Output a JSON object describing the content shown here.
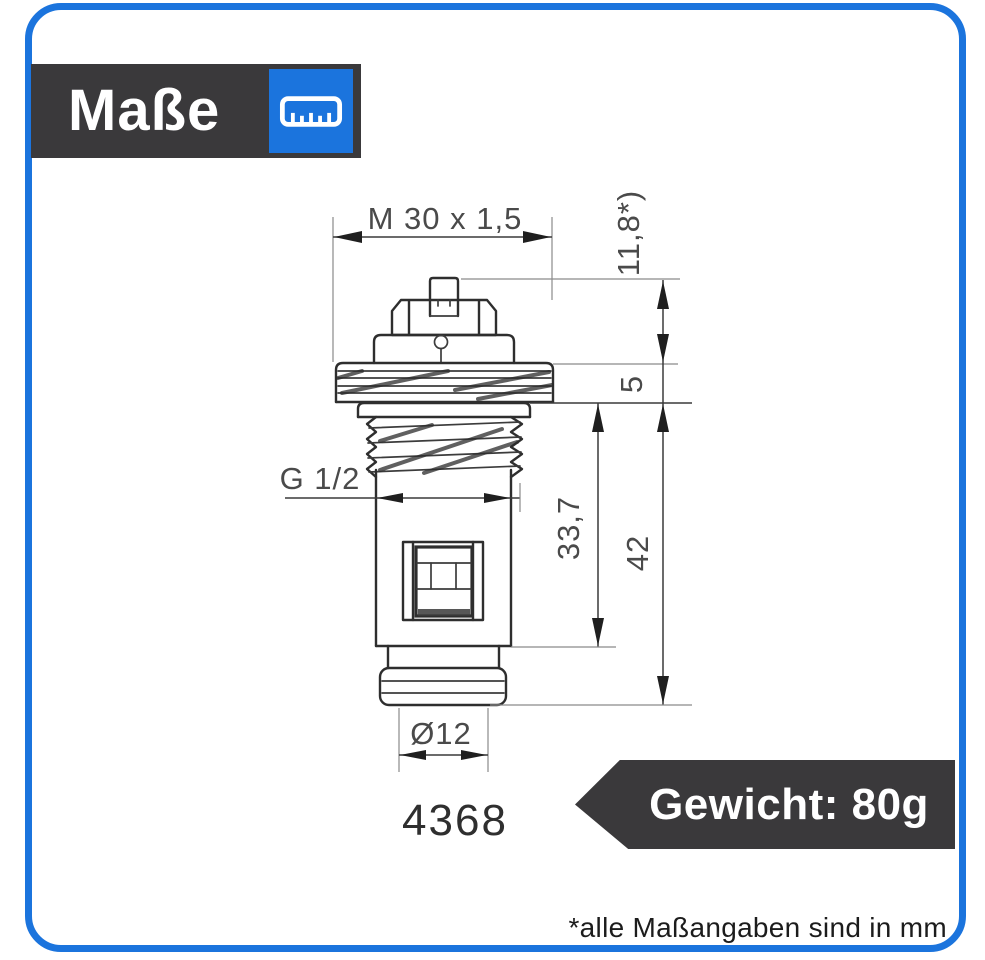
{
  "frame": {
    "border_color": "#1b74dd"
  },
  "header_badge": {
    "label": "Maße",
    "bg_color": "#3a393b",
    "icon": "ruler-icon",
    "icon_bg_color": "#1b74dd"
  },
  "weight_badge": {
    "label": "Gewicht: 80g",
    "bg_color": "#3a393b"
  },
  "footnote": "*alle Maßangaben sind in mm",
  "drawing": {
    "part_number": "4368",
    "dimensions": {
      "thread_top": "M 30 x 1,5",
      "height_above_thread": "11,8*)",
      "collar_height": "5",
      "thread_bottom": "G 1/2",
      "body_height": "33,7",
      "total_height": "42",
      "tail_diameter": "Ø12"
    }
  }
}
